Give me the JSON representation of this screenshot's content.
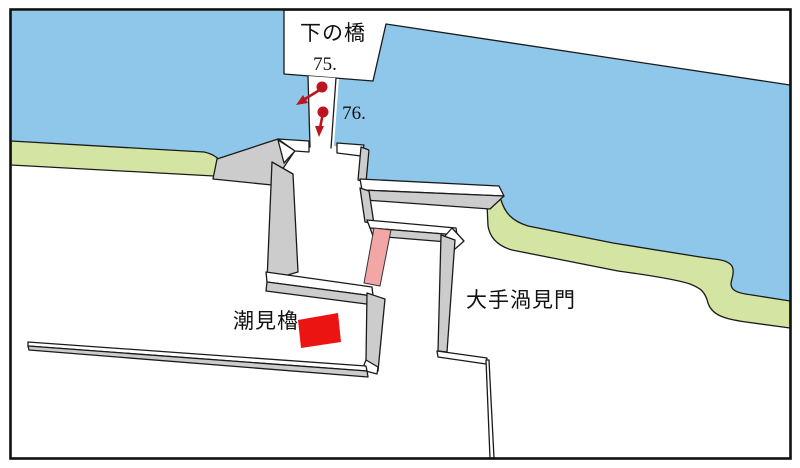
{
  "figure": {
    "type": "hand-drawn castle moat map",
    "labels": {
      "bridge": "下の橋",
      "shiomi_yagura": "潮見櫓",
      "ote_uzumi_gate": "大手渦見門"
    },
    "markers": {
      "m75": {
        "label": "75."
      },
      "m76": {
        "label": "76."
      }
    },
    "colors": {
      "water": "#8ec7e9",
      "bank": "#d4e5a3",
      "wall": "#cccccc",
      "gatehl": "#f2a6a6",
      "building": "#ec1313",
      "marker": "#bc1420",
      "line": "#1a1a1a"
    }
  }
}
